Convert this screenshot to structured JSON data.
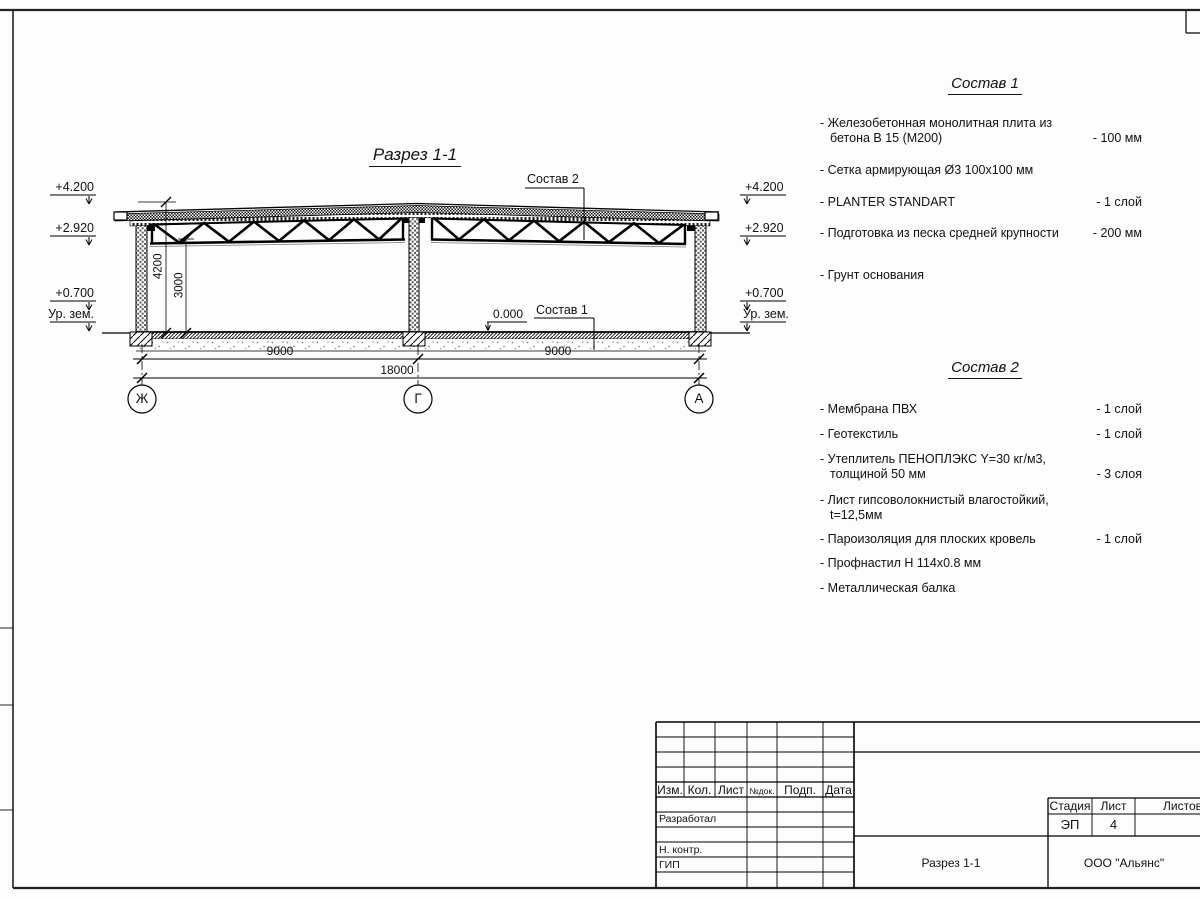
{
  "sheet": {
    "section_title": "Разрез 1-1",
    "elevations": {
      "roof_top": "+4.200",
      "truss_bottom": "+2.920",
      "plinth": "+0.700",
      "ground": "Ур. зем.",
      "zero": "0.000"
    },
    "dims": {
      "height_total": "4200",
      "height_clear": "3000",
      "bay_left": "9000",
      "bay_right": "9000",
      "total": "18000"
    },
    "axes": {
      "a1": "Ж",
      "a2": "Г",
      "a3": "А"
    },
    "callouts": {
      "sostav1": "Состав 1",
      "sostav2": "Состав 2"
    }
  },
  "sostav1": {
    "title": "Состав 1",
    "items": [
      {
        "name": "- Железобетонная  монолитная плита из бетона В 15 (М200)",
        "value": "- 100 мм"
      },
      {
        "name": "- Сетка армирующая Ø3 100х100 мм",
        "value": ""
      },
      {
        "name": "- PLANTER STANDART",
        "value": "-  1 слой"
      },
      {
        "name": "- Подготовка из песка средней крупности",
        "value": "- 200 мм"
      },
      {
        "name": "- Грунт основания",
        "value": ""
      }
    ]
  },
  "sostav2": {
    "title": "Состав 2",
    "items": [
      {
        "name": "- Мембрана ПВХ",
        "value": "- 1 слой"
      },
      {
        "name": "- Геотекстиль",
        "value": "- 1 слой"
      },
      {
        "name": "- Утеплитель ПЕНОПЛЭКС Y=30 кг/м3, толщиной 50 мм",
        "value": "- 3 слоя"
      },
      {
        "name": "- Лист гипсоволокнистый влагостойкий, t=12,5мм",
        "value": ""
      },
      {
        "name": "- Пароизоляция для плоских кровель",
        "value": "- 1 слой"
      },
      {
        "name": "- Профнастил Н 114х0.8 мм",
        "value": ""
      },
      {
        "name": "- Металлическая балка",
        "value": ""
      }
    ]
  },
  "titleblock": {
    "columns": [
      "Изм.",
      "Кол.",
      "Лист",
      "№док.",
      "Подп.",
      "Дата"
    ],
    "roles": [
      "Разработал",
      "Н. контр.",
      "ГИП"
    ],
    "stage_label": "Стадия",
    "sheet_label": "Лист",
    "sheets_label": "Листов",
    "stage_value": "ЭП",
    "sheet_value": "4",
    "doc_name": "Разрез 1-1",
    "company": "ООО \"Альянс\""
  }
}
